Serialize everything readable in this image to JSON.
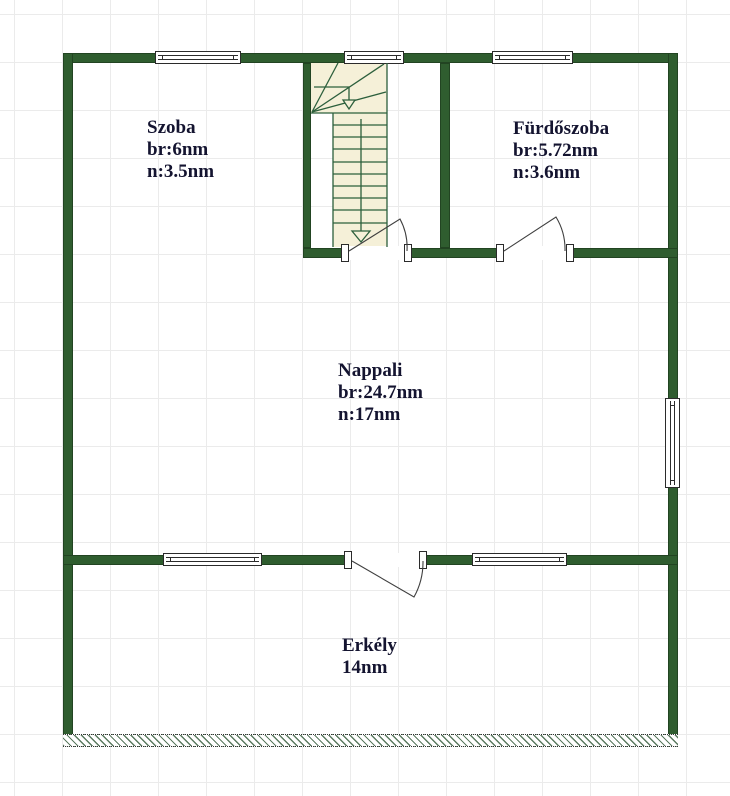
{
  "rooms": {
    "szoba": {
      "name": "Szoba",
      "gross": "br:6nm",
      "net": "n:3.5nm"
    },
    "furdoszoba": {
      "name": "Fürdőszoba",
      "gross": "br:5.72nm",
      "net": "n:3.6nm"
    },
    "nappali": {
      "name": "Nappali",
      "gross": "br:24.7nm",
      "net": "n:17nm"
    },
    "erkely": {
      "name": "Erkély",
      "area": "14nm"
    }
  },
  "colors": {
    "wall_green": "#2f5d2f",
    "stair_fill": "#f5f0d8",
    "stair_line": "#2c5f3c",
    "door_line": "#3f3f3f",
    "grid_line": "#ebebeb",
    "hatch_line": "#5b7a60",
    "label_text": "#141430"
  }
}
